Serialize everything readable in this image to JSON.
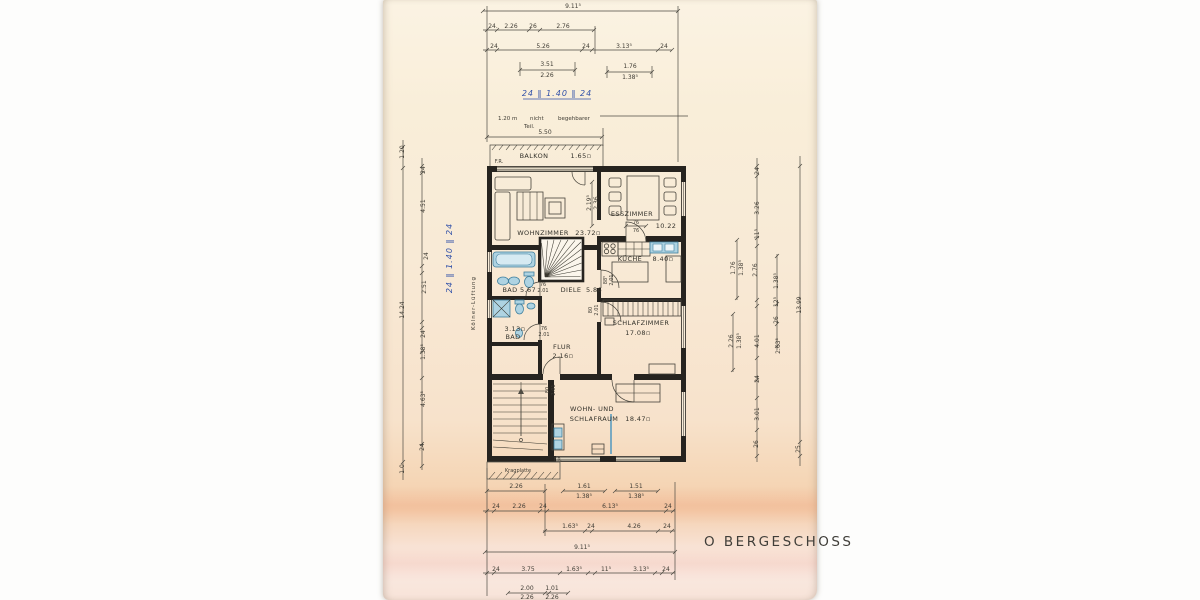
{
  "page": {
    "title": "O BERGESCHOSS"
  },
  "annotations": {
    "attic_note_1": "1.20 m",
    "attic_note_2": "nicht",
    "attic_note_3": "begehbarer",
    "attic_note_4": "Teil.",
    "handwritten": "24 ‖ 1.40 ‖ 24",
    "shaft": "Kölner-Lüftung",
    "kragplatte": "Kragplatte",
    "fr": "F.R."
  },
  "rooms": {
    "balkon": {
      "name": "BALKON",
      "area": "1.65▫"
    },
    "wohnzimmer": {
      "name": "WOHNZIMMER",
      "area": "23.72▫"
    },
    "esszimmer": {
      "name": "ESSZIMMER",
      "area": "10.22"
    },
    "kueche": {
      "name": "KÜCHE",
      "area": "8.40▫"
    },
    "bad_oben": {
      "name": "BAD",
      "area": "5.67"
    },
    "diele": {
      "name": "DIELE",
      "area": "5.86"
    },
    "bad_unten": {
      "name": "BAD",
      "area": "3.13▫"
    },
    "flur": {
      "name": "FLUR",
      "area": "2.16▫"
    },
    "schlafzimmer": {
      "name": "SCHLAFZIMMER",
      "area": "17.08▫"
    },
    "wohn_schlafraum": {
      "name_line1": "WOHN- UND",
      "name_line2": "SCHLAFRAUM",
      "area": "18.47▫"
    }
  },
  "doors": {
    "bad_oben": [
      "76",
      "2.01"
    ],
    "bad_unten": [
      "76",
      "2.01"
    ],
    "kueche": [
      "88⁵",
      "2.01"
    ],
    "schlafzimmer": [
      "80",
      "2.01"
    ],
    "flur": [
      "80",
      "2.01"
    ],
    "esszimmer": [
      "76",
      "76"
    ]
  },
  "dims": {
    "top": [
      "9.11⁵",
      "24.",
      "2.26",
      "26",
      "2.76",
      "24",
      "5.26",
      "24",
      "3.13⁵",
      "24",
      "3.51",
      "2.26",
      "1.76",
      "1.38⁵",
      "5.50"
    ],
    "left": [
      "1.20",
      "24",
      "4.51",
      "24",
      "2.51",
      "24",
      "1.38⁵",
      "14.24",
      "4.63⁵",
      "24",
      "1.0"
    ],
    "right": [
      "24",
      "3.26",
      "11⁵",
      "2.76",
      "1.76",
      "1.38⁵",
      "1.38⁵",
      "12⁵",
      "26",
      "2.26",
      "1.38⁵",
      "4.01",
      "2.63⁵",
      "24",
      "3.01",
      "26",
      "25",
      "13.99"
    ],
    "bottom": [
      "2.26",
      "1.61",
      "1.38⁵",
      "1.51",
      "1.38⁵",
      "24",
      "2.26",
      "24",
      "6.13⁵",
      "24",
      "1.63⁵",
      "24",
      "4.26",
      "24",
      "9.11⁵",
      "24",
      "3.75",
      "1.63⁵",
      "11⁵",
      "3.13⁵",
      "24",
      "2.00",
      "2.26",
      "1.01",
      "2.26"
    ],
    "inner": [
      "2.19⁵",
      "2.36"
    ]
  }
}
